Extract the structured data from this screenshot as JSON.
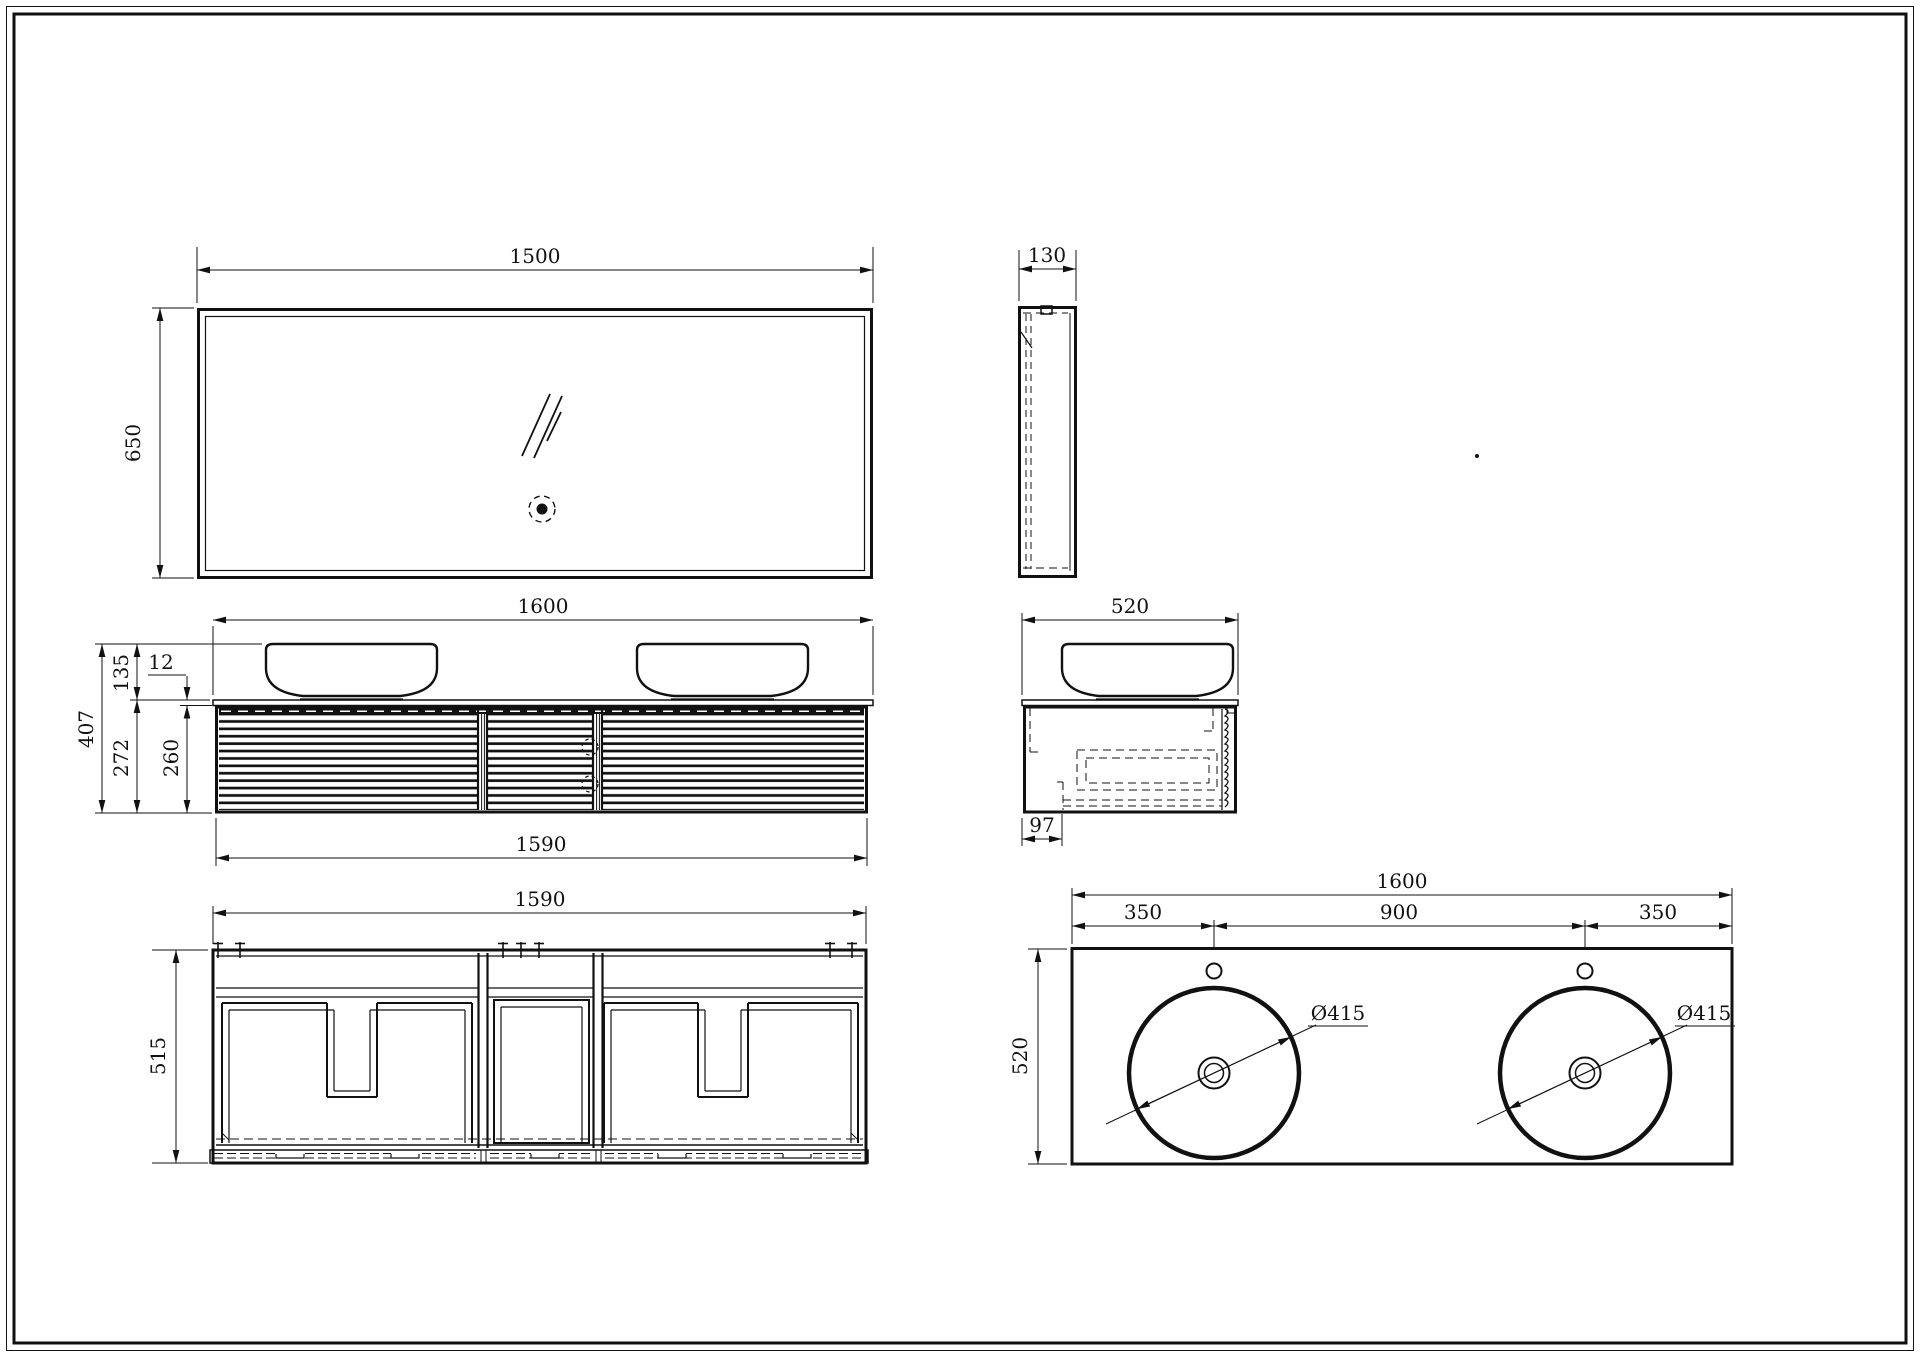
{
  "drawing": {
    "title": "Bathroom vanity technical drawing - six orthographic views",
    "background": "#ffffff",
    "line_color": "#111111",
    "views": {
      "mirror_front": {
        "label": "mirror front view",
        "dim_width": "1500",
        "dim_height": "650"
      },
      "mirror_side": {
        "label": "mirror side view",
        "dim_depth": "130"
      },
      "cabinet_front": {
        "label": "vanity front view",
        "dim_width_top": "1600",
        "dim_width_bottom": "1590",
        "dim_basin_height": "135",
        "dim_counter_thickness": "12",
        "dim_total_height": "407",
        "dim_cabinet_height": "272",
        "dim_drawer_front_height": "260"
      },
      "cabinet_side": {
        "label": "vanity side view",
        "dim_depth": "520",
        "dim_offset": "97"
      },
      "carcass_front": {
        "label": "cabinet carcass front view",
        "dim_width": "1590",
        "dim_height": "515"
      },
      "countertop_plan": {
        "label": "countertop plan view",
        "dim_width": "1600",
        "dim_left_offset": "350",
        "dim_center_spacing": "900",
        "dim_right_offset": "350",
        "dim_depth": "520",
        "dim_basin_left": "Ø415",
        "dim_basin_right": "Ø415"
      }
    }
  }
}
